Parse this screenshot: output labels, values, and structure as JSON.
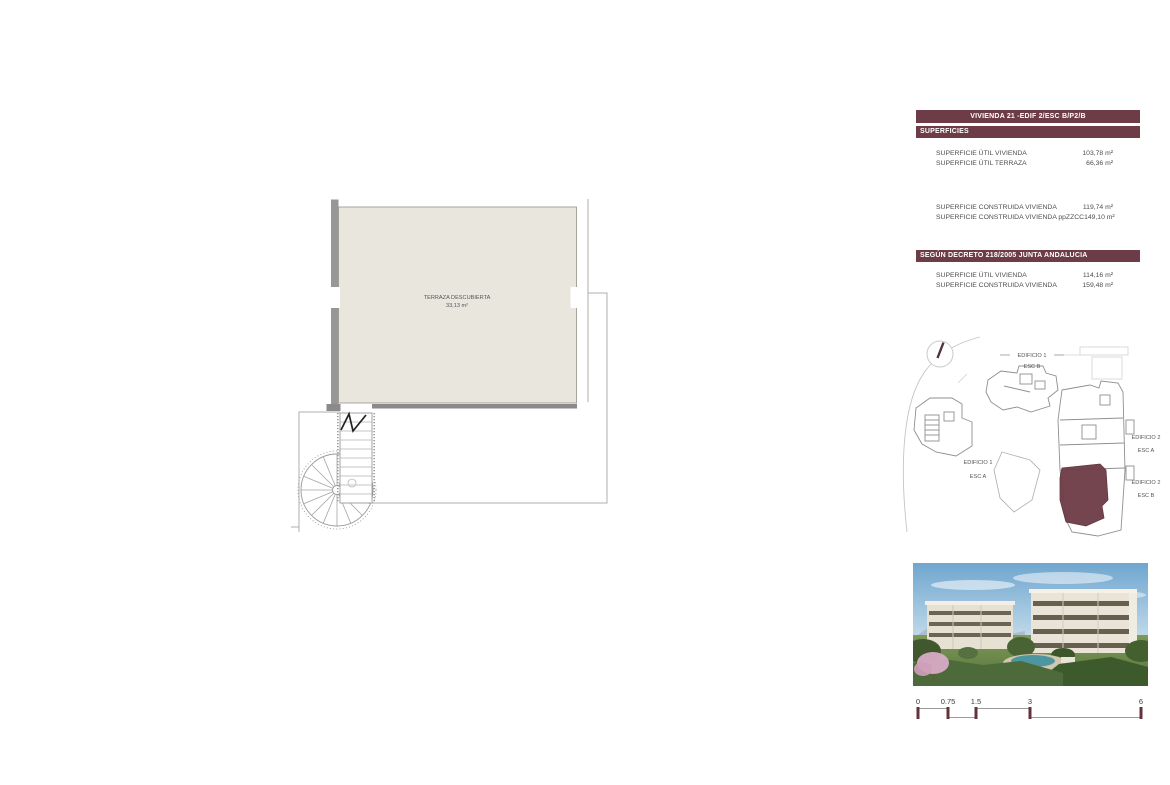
{
  "info_panel": {
    "title_bar": "VIVIENDA 21 -EDIF 2/ESC B/P2/B",
    "superficies_bar": "SUPERFICIES",
    "rows_superficies": [
      {
        "label": "SUPERFICIE ÚTIL VIVIENDA",
        "value": "103,78 m²"
      },
      {
        "label": "SUPERFICIE ÚTIL TERRAZA",
        "value": "66,36 m²"
      }
    ],
    "rows_construida": [
      {
        "label": "SUPERFICIE CONSTRUIDA VIVIENDA",
        "value": "119,74 m²"
      },
      {
        "label": "SUPERFICIE CONSTRUIDA VIVIENDA ppZZCC",
        "value": "149,10 m²"
      }
    ],
    "decreto_bar": "SEGÚN DECRETO 218/2005 JUNTA ANDALUCIA",
    "rows_decreto": [
      {
        "label": "SUPERFICIE ÚTIL VIVIENDA",
        "value": "114,16 m²"
      },
      {
        "label": "SUPERFICIE CONSTRUIDA VIVIENDA",
        "value": "159,48 m²"
      }
    ]
  },
  "floor_plan": {
    "room_label": "TERRAZA DESCUBIERTA",
    "room_area": "33,13 m²"
  },
  "site_plan": {
    "b1_top": "EDIFICIO 1",
    "b1_top_esc": "ESC B",
    "b1_left": "EDIFICIO 1",
    "b1_left_esc": "ESC A",
    "b2_a": "EDIFICIO 2",
    "b2_a_esc": "ESC A",
    "b2_b": "EDIFICIO 2",
    "b2_b_esc": "ESC B"
  },
  "scale_bar": {
    "labels": [
      "0",
      "0.75",
      "1.5",
      "3",
      "6"
    ]
  },
  "colors": {
    "maroon": "#6e3c46",
    "terrace_fill": "#e9e6dd",
    "wall_gray": "#979797",
    "line_gray": "#b2afa7",
    "text_dark": "#4d4d4d"
  }
}
